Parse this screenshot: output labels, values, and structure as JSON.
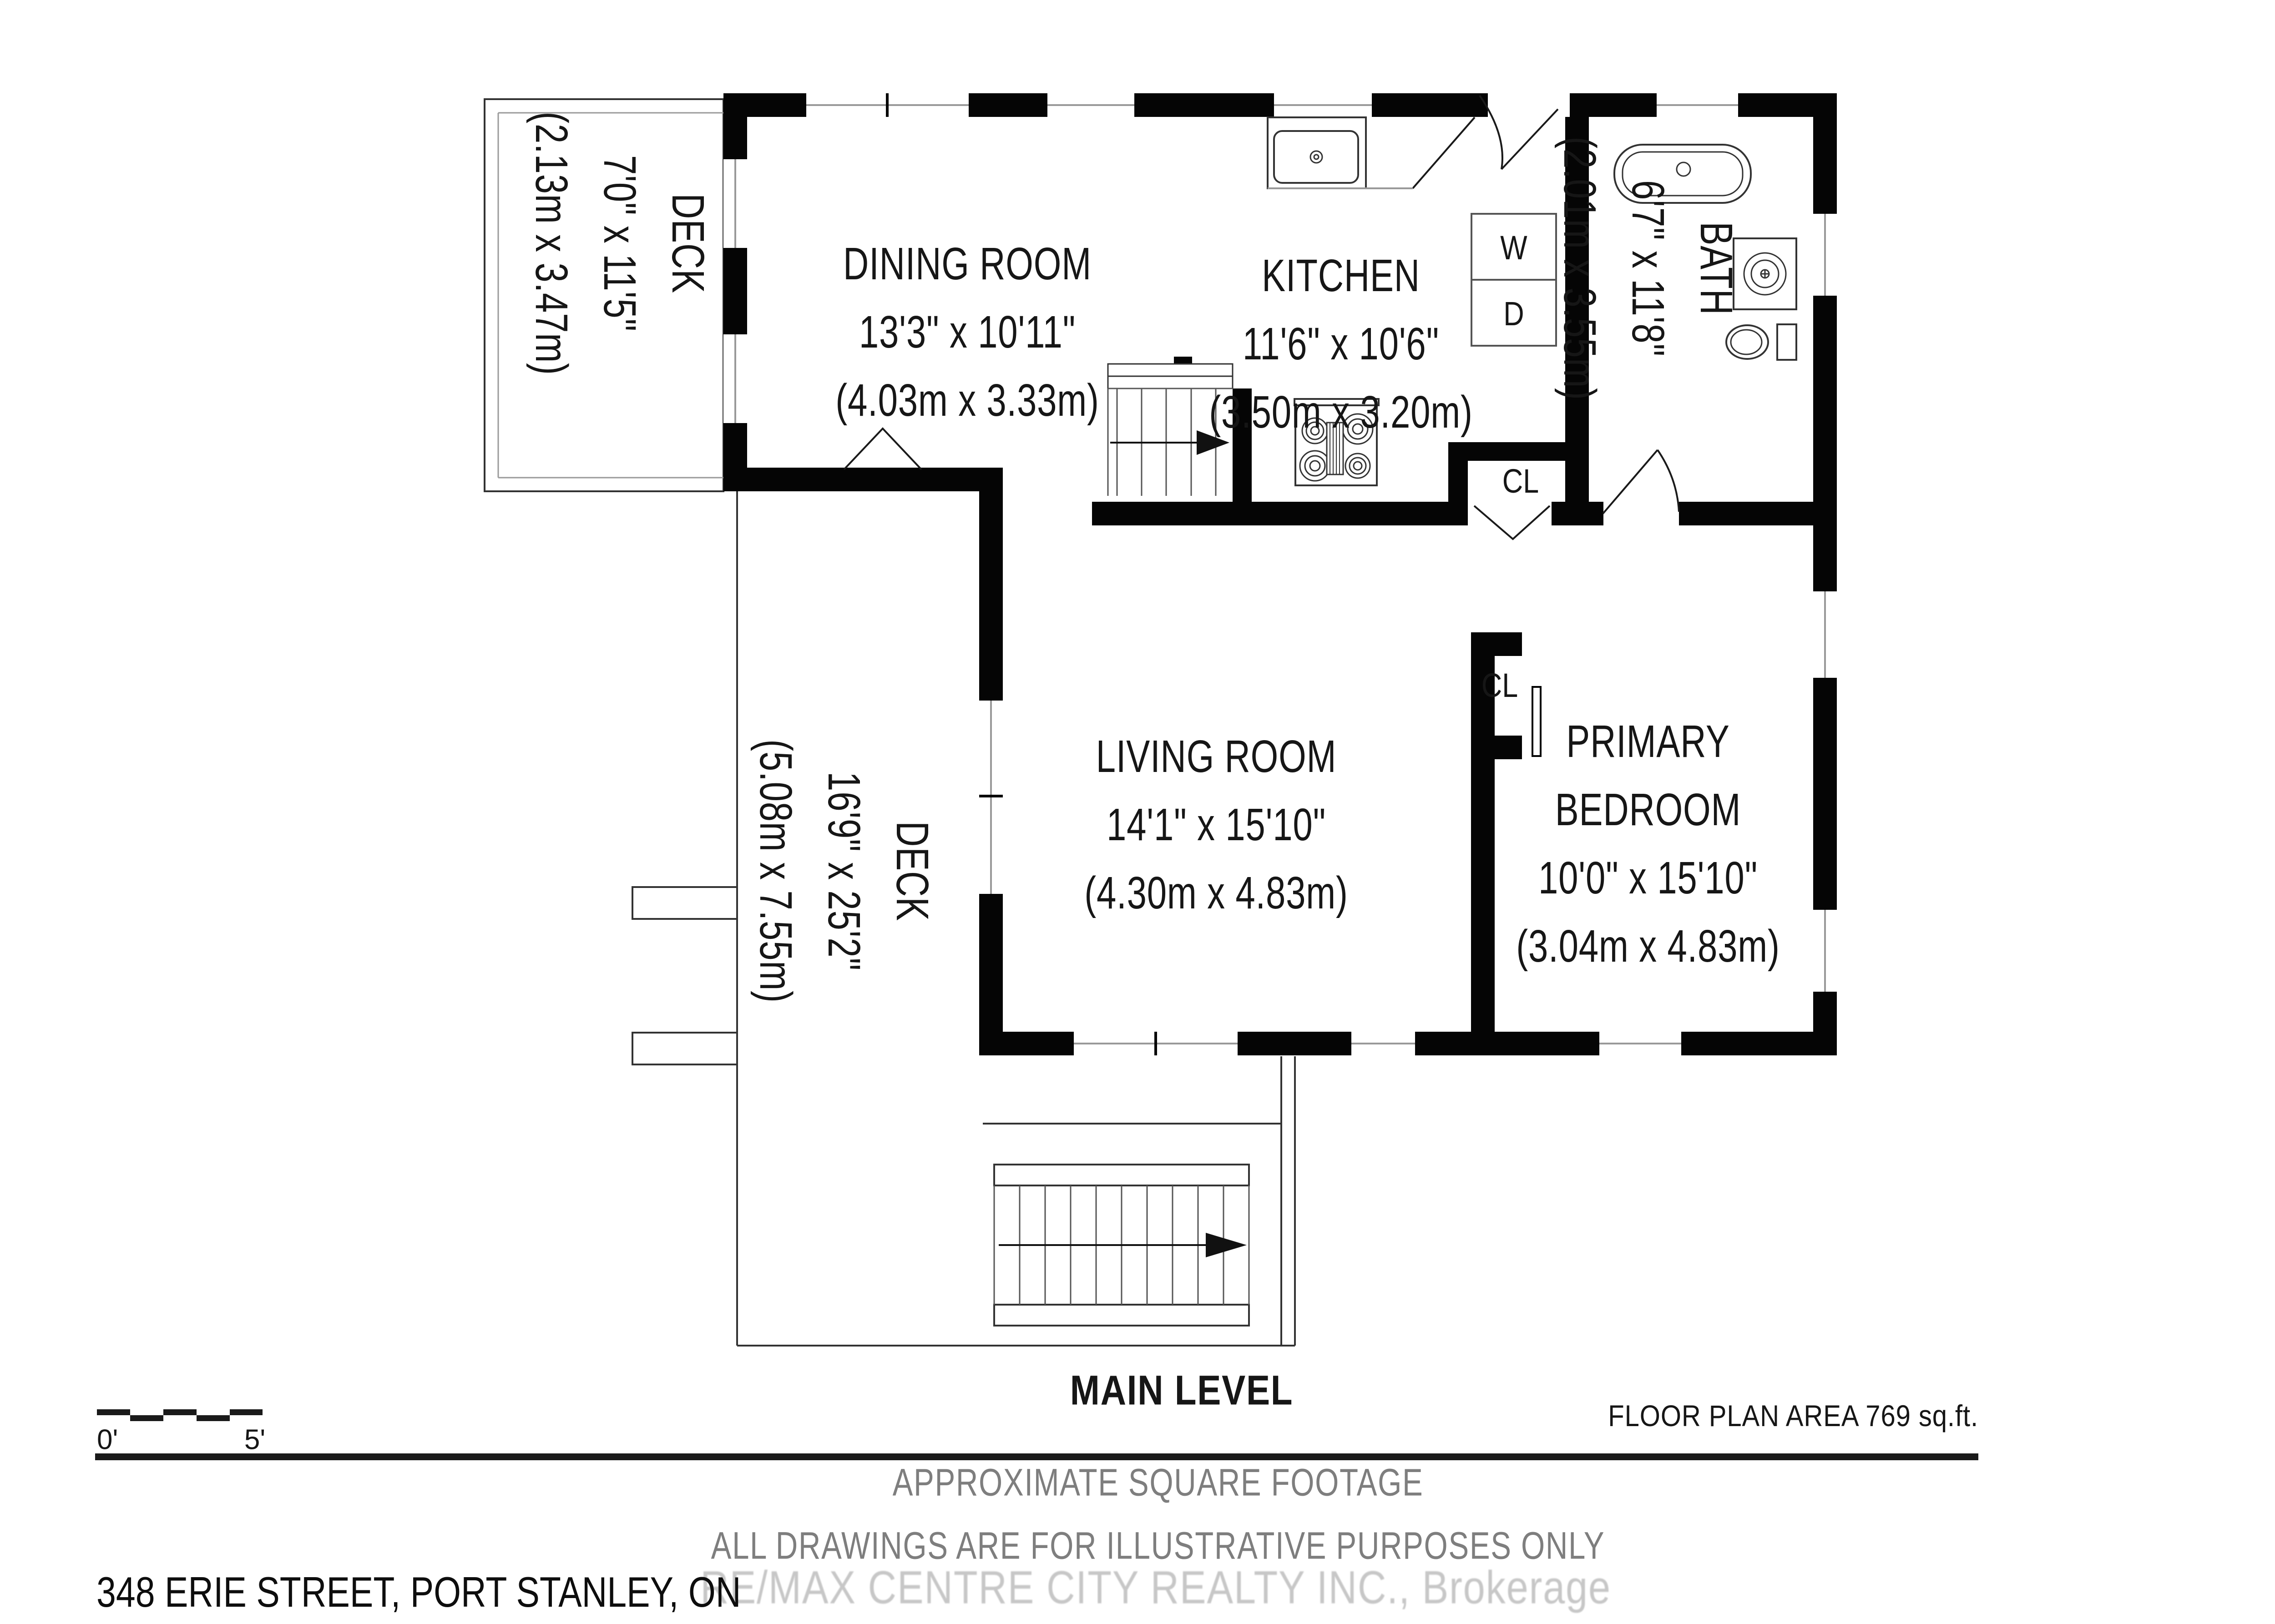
{
  "rooms": [
    {
      "id": "dining",
      "name": "DINING ROOM",
      "dims": "13'3\" x 10'11\"",
      "metric": "(4.03m x 3.33m)"
    },
    {
      "id": "kitchen",
      "name": "KITCHEN",
      "dims": "11'6\" x 10'6\"",
      "metric": "(3.50m x 3.20m)"
    },
    {
      "id": "living",
      "name": "LIVING ROOM",
      "dims": "14'1\" x 15'10\"",
      "metric": "(4.30m x 4.83m)"
    },
    {
      "id": "primary-bedroom",
      "name": "PRIMARY",
      "name2": "BEDROOM",
      "dims": "10'0\" x 15'10\"",
      "metric": "(3.04m x 4.83m)"
    },
    {
      "id": "bath",
      "name": "BATH",
      "dims": "6'7\" x 11'8\"",
      "metric": "(2.01m x 3.55m)"
    },
    {
      "id": "deck-upper",
      "name": "DECK",
      "dims": "7'0\" x 11'5\"",
      "metric": "(2.13m x 3.47m)"
    },
    {
      "id": "deck-lower",
      "name": "DECK",
      "dims": "16'9\" x 25'2\"",
      "metric": "(5.08m x 7.55m)"
    }
  ],
  "labels": {
    "closet_kitchen": "CL",
    "closet_bedroom": "CL",
    "washer": "W",
    "dryer": "D"
  },
  "footer": {
    "level_title": "MAIN LEVEL",
    "area_note": "FLOOR PLAN AREA 769 sq.ft.",
    "disclaimer1": "APPROXIMATE SQUARE FOOTAGE",
    "disclaimer2": "ALL DRAWINGS ARE FOR ILLUSTRATIVE PURPOSES ONLY",
    "watermark": "RE/MAX CENTRE CITY REALTY INC., Brokerage",
    "address": "348 ERIE STREET, PORT STANLEY, ON"
  },
  "scale_bar": {
    "start_label": "0'",
    "end_label": "5'"
  }
}
